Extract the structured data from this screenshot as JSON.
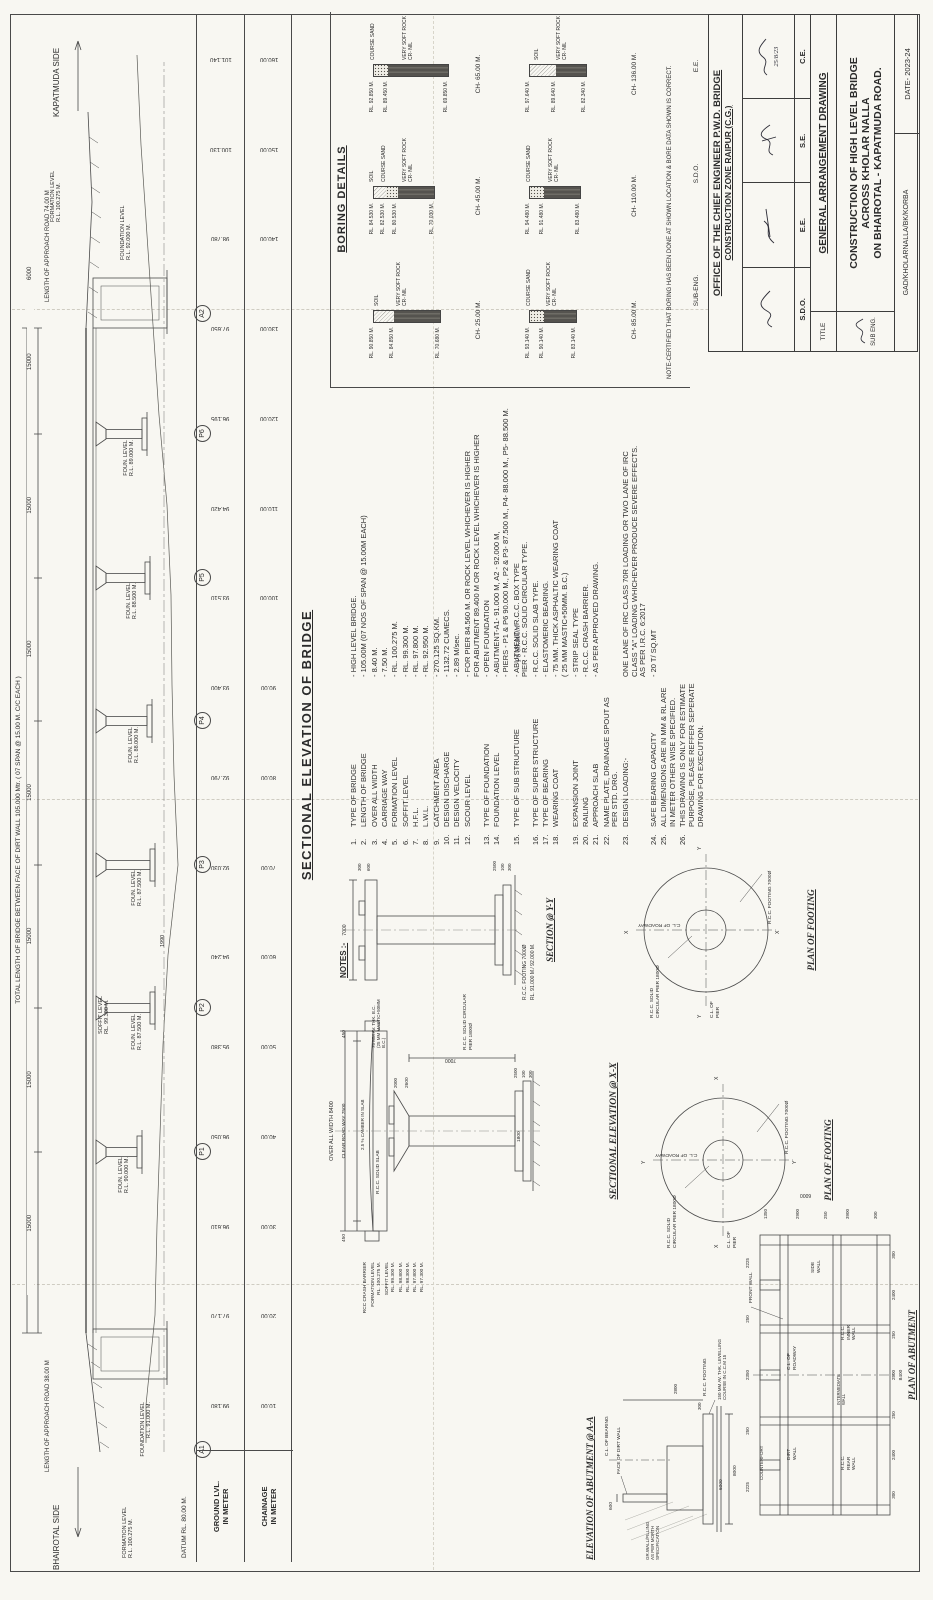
{
  "sheet": {
    "datum_label": "DATUM RL. 80.00 M.",
    "side_left": "BHAIROTAL SIDE",
    "side_right": "KAPATMUDA SIDE"
  },
  "elevation": {
    "title": "SECTIONAL ELEVATION OF BRIDGE",
    "total_length_label": "TOTAL LENGTH OF BRIDGE BETWEEN FACE OF DIRT WALL 105.000 Mtr. ( 07 SPAN @ 15.00 M. C/C EACH )",
    "approach_left": "LENGTH OF APPROACH ROAD 38.00 M",
    "approach_right": "LENGTH OF APPROACH ROAD 74.00 M",
    "span_dims": [
      "15000",
      "15000",
      "15000",
      "15000",
      "15000",
      "15000",
      "15000"
    ],
    "end_dim": "6000",
    "dim_1990": "1990",
    "formation_left": "FORMATION LEVEL\nR.L. 100.275 M.",
    "formation_right": "FORMATION LEVEL\nR.L. 100.275 M.",
    "soffit_label": "SOFFIT LEVEL\nRL. 99.300 M.",
    "abutments": [
      {
        "id": "A1",
        "foundation": "FOUNDATION LEVEL\nR.L. 91.000 M."
      },
      {
        "id": "A2",
        "foundation": "FOUNDATION LEVEL\nR.L. 92.000 M."
      }
    ],
    "piers": [
      {
        "id": "P1",
        "foundation": "FOUN. LEVEL\nR.L. 90.000 M."
      },
      {
        "id": "P2",
        "foundation": "FOUN. LEVEL\nR.L. 87.500 M."
      },
      {
        "id": "P3",
        "foundation": "FOUN. LEVEL\nR.L. 87.500 M."
      },
      {
        "id": "P4",
        "foundation": "FOUN. LEVEL\nR.L. 88.000 M."
      },
      {
        "id": "P5",
        "foundation": "FOUN. LEVEL\nR.L. 88.500 M."
      },
      {
        "id": "P6",
        "foundation": "FOUN. LEVEL\nR.L. 89.000 M."
      }
    ],
    "scale": {
      "ground_header": "GROUND LVL.\nIN METER",
      "chainage_header": "CHAINAGE\nIN METER",
      "ground_levels": [
        "99.180",
        "97.170",
        "96.610",
        "96.050",
        "95.380",
        "94.240",
        "92.030",
        "92.790",
        "93.400",
        "93.510",
        "94.420",
        "96.195",
        "97.650",
        "98.780",
        "100.130",
        "101.140"
      ],
      "chainages": [
        "10.00",
        "20.00",
        "30.00",
        "40.00",
        "50.00",
        "60.00",
        "70.00",
        "80.00",
        "90.00",
        "100.00",
        "110.00",
        "120.00",
        "130.00",
        "140.00",
        "150.00",
        "160.00"
      ]
    }
  },
  "notes": {
    "header": "NOTES :-",
    "hand14": "P6 89.000M",
    "items": [
      {
        "no": "1.",
        "label": "TYPE OF BRIDGE",
        "value": "- HIGH LEVEL BRIDGE."
      },
      {
        "no": "2.",
        "label": "LENGTH OF BRIDGE",
        "value": "- 105.00M (07 NOS OF SPAN @ 15.00M EACH)"
      },
      {
        "no": "3.",
        "label": "OVER ALL WIDTH",
        "value": "- 8.40 M."
      },
      {
        "no": "4.",
        "label": "CARRIAGE WAY",
        "value": "- 7.50 M."
      },
      {
        "no": "5.",
        "label": "FORMATION LEVEL",
        "value": "- RL. 100.275 M."
      },
      {
        "no": "6.",
        "label": "SOFFIT LEVEL",
        "value": "- RL. 99.300 M."
      },
      {
        "no": "7.",
        "label": "H.F.L.",
        "value": "- RL. 97.800 M."
      },
      {
        "no": "8.",
        "label": "L.W.L.",
        "value": "- RL. 92.950 M."
      },
      {
        "no": "9.",
        "label": "CATCHMENT AREA",
        "value": "- 270.125 SQ.KM."
      },
      {
        "no": "10.",
        "label": "DESIGN DISCHARGE",
        "value": "- 1132.72 CUMECS."
      },
      {
        "no": "11.",
        "label": "DESIGN VELOCITY",
        "value": "- 2.89 M/sec."
      },
      {
        "no": "12.",
        "label": "SCOUR LEVEL",
        "value": "- FOR PIER 84.560 M. OR ROCK LEVEL WHICHEVER IS HIGHER\nFOR ABUTMENT 89.400 M OR ROCK LEVEL WHICHEVER IS HIGHER"
      },
      {
        "no": "13.",
        "label": "TYPE OF FOUNDATION",
        "value": "- OPEN  FOUNDATION"
      },
      {
        "no": "14.",
        "label": "FOUNDATION LEVEL",
        "value": "- ABUTMENT-A1- 91.000 M,  A2 - 92.000 M,\n- PIERS - P1 & P6 90.000 M., P2 & P3- 87.500 M., P4- 88.000 M., P5- 88.500 M."
      },
      {
        "no": "15.",
        "label": "TYPE OF SUB STRUCTURE",
        "value": "- ABUTMENT - R.C.C. BOX TYPE\nPIER - R.C.C. SOLID CIRCULAR TYPE."
      },
      {
        "no": "16.",
        "label": "TYPE OF SUPER STRUCTURE",
        "value": "- R.C.C. SOLID SLAB TYPE."
      },
      {
        "no": "17.",
        "label": "TYPE OF BEARING",
        "value": "- ELASTOMERIC BEARING."
      },
      {
        "no": "18.",
        "label": "WEARING COAT",
        "value": "- 75 MM. THICK ASPHALTIC WEARING COAT\n( 25 MM MASTIC+50MM. B.C.)"
      },
      {
        "no": "19.",
        "label": "EXPANSION JOINT",
        "value": "- STRIP SEAL TYPE"
      },
      {
        "no": "20.",
        "label": "RAILING",
        "value": "- R.C.C. CRASH BARRIER."
      },
      {
        "no": "21.",
        "label": "APPROACH SLAB",
        "value": "- AS PER APPROVED DRAWING."
      },
      {
        "no": "22.",
        "label": "NAME PLATE, DRAINAGE SPOUT AS PER STD. DRG.",
        "value": ""
      },
      {
        "no": "23.",
        "label": "DESIGN LOADING:-",
        "value": "ONE LANE OF IRC CLASS 70R LOADING OR TWO LANE OF IRC\nCLASS \"A\" LOADING WHICHEVER PRODUCE SEVERE EFFECTS.\nAS PER I.R.C. 6:2017"
      },
      {
        "no": "24.",
        "label": "SAFE BEARING CAPACITY",
        "value": "- 20 T/ SQ.MT"
      },
      {
        "no": "25.",
        "label": "ALL DIMENSIONS ARE IN MM & RL ARE IN METER OTHER WISE SPECIFIED.",
        "value": ""
      },
      {
        "no": "26.",
        "label": "THIS DRAWING IS ONLY FOR ESTIMATE PURPOSE, PLEASE REFFER SEPERATE DRAWING FOR EXECUTION.",
        "value": ""
      }
    ]
  },
  "boring": {
    "title": "BORING DETAILS",
    "note": "NOTE-CERTIFIED THAT BORING HAS BEEN DONE AT SHOWN LOCATION & BORE DATA SHOWN IS CORRECT.",
    "bores": [
      {
        "ch": "CH- 25.00 M.",
        "rl0": "RL. 90.850 M.",
        "rl1": "RL. 84.850 M.",
        "rl2": "RL. 70.680 M.",
        "n1": "SOIL",
        "n2": "VERY SOFT ROCK CR- NIL"
      },
      {
        "ch": "CH- 45.00 M.",
        "rl0": "RL. 84.530 M.",
        "rl1": "RL. 82.530 M.",
        "rl2": "RL. 80.530 M.",
        "rl3": "RL. 70.030 M.",
        "n1": "SOIL",
        "n2": "COURSE SAND",
        "n3": "VERY SOFT ROCK CR- NIL"
      },
      {
        "ch": "CH- 65.00 M.",
        "rl0": "RL. 92.850 M.",
        "rl1": "RL. 89.450 M.",
        "rl2": "RL. 69.850 M.",
        "n1": "COURSE SAND",
        "n2": "VERY SOFT ROCK CR- NIL"
      },
      {
        "ch": "CH- 85.00 M.",
        "rl0": "RL. 93.140 M.",
        "rl1": "RL. 90.140 M.",
        "rl2": "RL. 83.140 M.",
        "n1": "COURSE SAND",
        "n2": "VERY SOFT ROCK CR- NIL"
      },
      {
        "ch": "CH- 110.00 M.",
        "rl0": "RL. 94.480 M.",
        "rl1": "RL. 91.480 M.",
        "rl2": "RL. 83.480 M.",
        "n1": "COURSE SAND",
        "n2": "VERY SOFT ROCK CR- NIL"
      },
      {
        "ch": "CH- 136.00 M.",
        "rl0": "RL. 97.640 M.",
        "rl1": "RL. 89.640 M.",
        "rl2": "RL. 82.340 M.",
        "n1": "SOIL",
        "n2": "VERY SOFT ROCK CR- NIL"
      }
    ]
  },
  "sections": {
    "xx": {
      "title": "SECTIONAL ELEVATION @ X-X",
      "overall_width": "OVER ALL WIDTH  8400",
      "clear_roadway": "CLEAR ROAD WAY  7500",
      "edge_dim": "450",
      "crash_barrier": "RCC CRASH BARRIER",
      "formation": "FORMATION LEVEL\nRL. 100.275 M.",
      "soffit": "SOFFIT LEVEL\nRL. 99.300 M.",
      "levels": [
        "RL. 98.800 M.",
        "RL. 98.300 M.",
        "RL. 97.800 M.",
        "RL. 97.300 M."
      ],
      "camber": "2.5 % CAMBER IN SLAB",
      "solid_slab": "R.C.C. SOLID SLAB",
      "wearing": "75 MM AV. THK. B.C.\n(25 MM MASTIC+50MM B.C.)",
      "pier_label": "R.C.C. SOLID CIRCULAR\nPIER 1800Ø",
      "dims": {
        "height": "7000",
        "shaft": "1800",
        "cap": "2600",
        "cap_h": "2000",
        "f1": "2500",
        "f2": "100",
        "f3": "300"
      }
    },
    "yy": {
      "title": "SECTION @ Y-Y",
      "top_dim": "7000",
      "dims": {
        "cap_t": "300",
        "cap_h": "600",
        "f1": "2500",
        "f2": "100",
        "f3": "300"
      },
      "footing_label": "R.C.C. FOOTING 7000Ø",
      "footing_rl": "RL. 91.000 M./ 92.000 M."
    },
    "footing_plan": {
      "title": "PLAN OF FOOTING",
      "cl_roadway": "C.L. OF ROADWAY",
      "cl_pier": "C.L. OF\nPIER",
      "pier_label": "R.C.C. SOLID\nCIRCULAR PIER 1800Ø",
      "footing_label": "R.C.C. FOOTING 7000Ø",
      "axis_x": "X",
      "axis_y": "Y"
    },
    "abut_elev": {
      "title": "ELEVATION OF ABUTMENT @ A-A",
      "face_dirt_wall": "FACE OF DIRT WALL",
      "cl_bearing": "C.L. OF BEARING",
      "fill_note": "GR.WALL/FILLING\nAS PER MORTH\nSPECIFICATION",
      "levelling": "150 MM AV. THK. LEVELLING\nCOURSE IN C.C.M 15",
      "rcc_footing": "R.C.C. FOOTING",
      "dims": {
        "d600": "600",
        "d6000": "6000",
        "d8000": "8000",
        "d300": "300",
        "d2800": "2800"
      }
    },
    "abut_plan": {
      "title": "PLAN OF ABUTMENT",
      "labels": {
        "dirt_wall": "DIRT\nWALL",
        "counterfort": "COUNTERFORT",
        "cl_roadway": "C.L. OF\nROADWAY",
        "front_wall": "FRONT WALL",
        "side_wall": "SIDE\nWALL",
        "rear_wall": "R.C.C.\nREAR\nWALL",
        "inner_wall": "R.C.C.\nINNER\nWALL",
        "intermediate": "INTERMEDIATE\nWALL"
      },
      "dims_top": [
        "2225",
        "250",
        "2350",
        "250",
        "2225"
      ],
      "dims_bottom": [
        "300",
        "2400",
        "250",
        "2500",
        "250",
        "2400",
        "300"
      ],
      "dims_right": [
        "1350",
        "2900",
        "250",
        "3900",
        "300"
      ],
      "width_total": "8400",
      "depth_total": "6000"
    }
  },
  "title_block": {
    "sig_strip": [
      "SUB-ENG.",
      "S.D.O.",
      "E.E."
    ],
    "office_line1": "OFFICE OF THE CHIEF ENGINEER P.W.D. BRIDGE",
    "office_line2": "CONSTRUCTION ZONE RAIPUR (C.G.)",
    "approvals": [
      "S.D.O.",
      "E.E.",
      "S.E.",
      "C.E."
    ],
    "approval_date": "25/8/23",
    "title_label": "TITLE",
    "drawing_type": "GENERAL ARRANGEMENT DRAWING",
    "project_title": "CONSTRUCTION OF HIGH LEVEL BRIDGE\nACROSS KHOLAR NALLA\nON BHAIROTAL - KAPATMUDA ROAD.",
    "sub_eng_label": "SUB ENG.",
    "drawing_no": "GAD/KHOLARNALLA/BK/KORBA",
    "date_label": "DATE- 2023-24"
  }
}
